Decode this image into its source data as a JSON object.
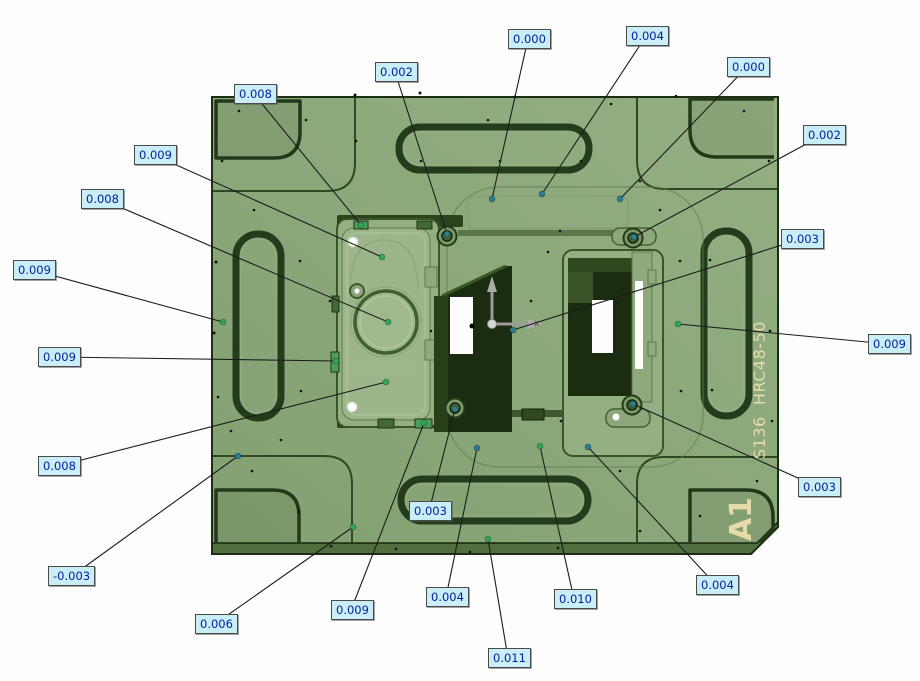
{
  "viewport": {
    "width": 920,
    "height": 681,
    "background": "#fdfdfe"
  },
  "part": {
    "material_label": "S136  HRC48-50",
    "corner_label": "A1",
    "colors": {
      "face": "#8ba87b",
      "face_dark_edge": "#1c2f12",
      "groove": "#223919",
      "pocket_dark": "#1b2c10",
      "engraved_text": "#e5dba9"
    }
  },
  "style": {
    "leader_color": "#1c1c1c",
    "label_bg": "#c9eef8",
    "label_border": "#4a4a4a",
    "label_text": "#04229e",
    "point_colors": {
      "green": "#2fa65c",
      "teal": "#2a7d90"
    }
  },
  "axis_triad": {
    "x_label": "x",
    "color": "#9d9d9d"
  },
  "measurements": [
    {
      "value": "0.008",
      "box": {
        "x": 234,
        "y": 84
      },
      "point": {
        "x": 361,
        "y": 225
      },
      "point_color": "green"
    },
    {
      "value": "0.002",
      "box": {
        "x": 375,
        "y": 62
      },
      "point": {
        "x": 447,
        "y": 234
      },
      "point_color": "teal"
    },
    {
      "value": "0.000",
      "box": {
        "x": 508,
        "y": 29
      },
      "point": {
        "x": 492,
        "y": 199
      },
      "point_color": "teal"
    },
    {
      "value": "0.004",
      "box": {
        "x": 626,
        "y": 26
      },
      "point": {
        "x": 542,
        "y": 194
      },
      "point_color": "teal"
    },
    {
      "value": "0.000",
      "box": {
        "x": 727,
        "y": 57
      },
      "point": {
        "x": 620,
        "y": 199
      },
      "point_color": "teal"
    },
    {
      "value": "0.002",
      "box": {
        "x": 803,
        "y": 125
      },
      "point": {
        "x": 634,
        "y": 237
      },
      "point_color": "teal"
    },
    {
      "value": "0.003",
      "box": {
        "x": 781,
        "y": 229
      },
      "point": {
        "x": 513,
        "y": 330
      },
      "point_color": "teal"
    },
    {
      "value": "0.009",
      "box": {
        "x": 868,
        "y": 334
      },
      "point": {
        "x": 678,
        "y": 324
      },
      "point_color": "green"
    },
    {
      "value": "0.003",
      "box": {
        "x": 798,
        "y": 477
      },
      "point": {
        "x": 633,
        "y": 404
      },
      "point_color": "teal"
    },
    {
      "value": "0.004",
      "box": {
        "x": 696,
        "y": 575
      },
      "point": {
        "x": 588,
        "y": 447
      },
      "point_color": "teal"
    },
    {
      "value": "0.010",
      "box": {
        "x": 554,
        "y": 589
      },
      "point": {
        "x": 540,
        "y": 446
      },
      "point_color": "green"
    },
    {
      "value": "0.011",
      "box": {
        "x": 488,
        "y": 648
      },
      "point": {
        "x": 488,
        "y": 539
      },
      "point_color": "green"
    },
    {
      "value": "0.004",
      "box": {
        "x": 426,
        "y": 587
      },
      "point": {
        "x": 477,
        "y": 448
      },
      "point_color": "teal"
    },
    {
      "value": "0.003",
      "box": {
        "x": 409,
        "y": 501
      },
      "point": {
        "x": 455,
        "y": 409
      },
      "point_color": "teal"
    },
    {
      "value": "0.009",
      "box": {
        "x": 331,
        "y": 600
      },
      "point": {
        "x": 424,
        "y": 423
      },
      "point_color": "green"
    },
    {
      "value": "0.006",
      "box": {
        "x": 195,
        "y": 614
      },
      "point": {
        "x": 353,
        "y": 527
      },
      "point_color": "green"
    },
    {
      "value": "-0.003",
      "box": {
        "x": 48,
        "y": 566
      },
      "point": {
        "x": 238,
        "y": 456
      },
      "point_color": "teal"
    },
    {
      "value": "0.008",
      "box": {
        "x": 38,
        "y": 456
      },
      "point": {
        "x": 386,
        "y": 382
      },
      "point_color": "green"
    },
    {
      "value": "0.009",
      "box": {
        "x": 38,
        "y": 347
      },
      "point": {
        "x": 336,
        "y": 361
      },
      "point_color": "green"
    },
    {
      "value": "0.009",
      "box": {
        "x": 13,
        "y": 260
      },
      "point": {
        "x": 223,
        "y": 322
      },
      "point_color": "green"
    },
    {
      "value": "0.008",
      "box": {
        "x": 81,
        "y": 189
      },
      "point": {
        "x": 388,
        "y": 322
      },
      "point_color": "green"
    },
    {
      "value": "0.009",
      "box": {
        "x": 134,
        "y": 145
      },
      "point": {
        "x": 382,
        "y": 257
      },
      "point_color": "green"
    }
  ]
}
